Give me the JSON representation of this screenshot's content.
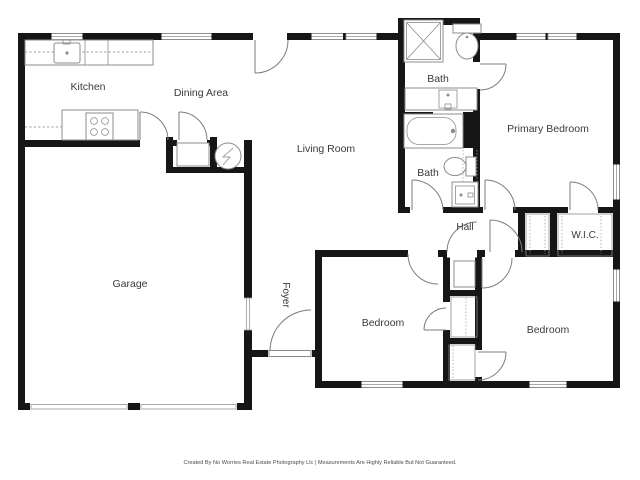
{
  "rooms": {
    "kitchen": {
      "label": "Kitchen"
    },
    "dining": {
      "label": "Dining Area"
    },
    "living": {
      "label": "Living Room"
    },
    "bath_top": {
      "label": "Bath"
    },
    "primary_bedroom": {
      "label": "Primary Bedroom"
    },
    "bath_lower": {
      "label": "Bath"
    },
    "hall": {
      "label": "Hall"
    },
    "wic": {
      "label": "W.I.C."
    },
    "garage": {
      "label": "Garage"
    },
    "foyer": {
      "label": "Foyer"
    },
    "bedroom_left": {
      "label": "Bedroom"
    },
    "bedroom_right": {
      "label": "Bedroom"
    }
  },
  "fixtures": {
    "kitchen": [
      "counter",
      "sink",
      "stove"
    ],
    "bath_top": [
      "shower",
      "toilet",
      "sink-vanity"
    ],
    "bath_lower": [
      "bathtub",
      "toilet",
      "sink-vanity"
    ],
    "utility": [
      "water-heater",
      "furnace-platform"
    ]
  },
  "footer": {
    "credit": "Created By No Worries Real Estate Photography Llc | Measurements Are Highly Reliable But Not Guaranteed."
  },
  "colors": {
    "wall": "#161616",
    "fixture": "#8c8c8c",
    "door": "#7d7d7d",
    "label_text": "#3a3a3a",
    "footer_text": "#4c4c4c",
    "background": "#ffffff"
  }
}
